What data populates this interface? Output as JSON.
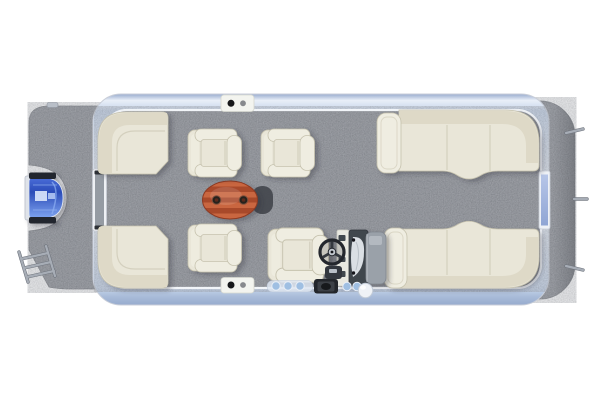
{
  "image": {
    "description": "Overhead 3D render of a pontoon boat floor plan on a white background",
    "canvas_width": 600,
    "canvas_height": 400
  },
  "colors": {
    "background": "#ffffff",
    "carpet": "#8b8e94",
    "carpet-dark": "#74777d",
    "carpet-speck-dark": "#55585e",
    "carpet-speck-light": "#c6c9cf",
    "rail-light": "#f2f6fb",
    "rail-mid": "#c5d4ea",
    "rail-deep": "#97abce",
    "hull-line": "#c9ced8",
    "furn-base": "#e9e6d8",
    "furn-hi": "#efede1",
    "furn-mid": "#ded9c7",
    "furn-line": "#c6c2ae",
    "furn-seam": "#d4d0be",
    "table-dark": "#a8482c",
    "table-light": "#c9663f",
    "table-rim": "#8d3a22",
    "cup-dark": "#26211d",
    "shadow-blob": "#43464d",
    "motor-blue": "#4a6cd8",
    "motor-blue-deep": "#2b4cb8",
    "motor-blue-light": "#7ea3f0",
    "motor-cap": "#20252e",
    "console-dark": "#41464e",
    "console-gray": "#9aa1a9",
    "wheel-dark": "#24272d",
    "accent-blue": "#9fbfe2",
    "metal": "#a7adb6",
    "gate-lavender-1": "#b7c6e8",
    "gate-lavender-2": "#8fa5d4"
  },
  "objects": {
    "bow_platform": "bow-deck-carpet",
    "trolling_motor": "blue-trolling-motor",
    "boarding_ladder": "boarding-ladder",
    "front_gate": "bow-gate",
    "rear_gate": "stern-gate",
    "port_bow_couch": "corner-couch-top-left",
    "starboard_bow_couch": "corner-couch-bottom-left",
    "armchairs": [
      "armchair-top-1",
      "armchair-top-2",
      "armchair-bottom"
    ],
    "table": "oval-teak-table-with-cupholders",
    "helm": {
      "console": "helm-console",
      "wheel": "steering-wheel",
      "seat": "captain-chair"
    },
    "port_stern_lounge": "chaise-lounge-top-right",
    "starboard_stern_lounge": "chaise-lounge-bottom-right",
    "stern_platform": "stern-deck-carpet",
    "gate_latches": [
      "top-gate-latch",
      "bottom-gate-latch"
    ],
    "gunwale_fittings": [
      "cup-holder-row",
      "speaker",
      "round-fender"
    ]
  }
}
